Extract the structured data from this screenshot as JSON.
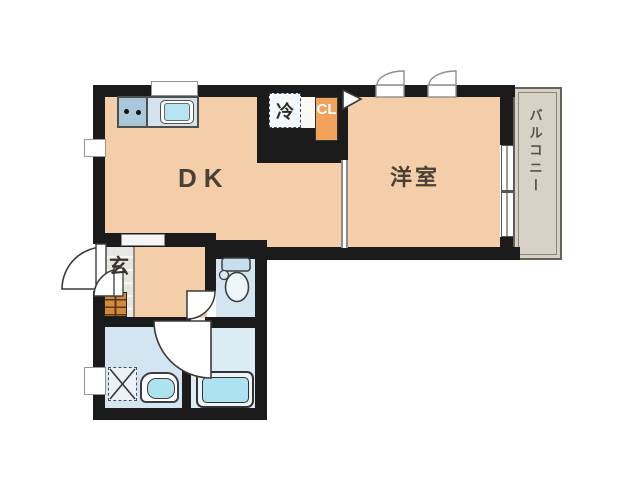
{
  "plan": {
    "title": "apartment-floor-plan",
    "rooms": {
      "dk_label": "DK",
      "western_room_label": "洋室",
      "balcony_label": "バルコニー",
      "entrance_label": "玄",
      "closet_label": "CL",
      "refrigerator_label": "冷"
    },
    "colors": {
      "room_fill": "#f4cda9",
      "wet_area_fill": "#d2e5f1",
      "wall": "#1b1b1b",
      "closet_orange": "#f1a35c",
      "fixture_cyan": "#aee2f0",
      "balcony_fill": "#d8d2c6",
      "shoe_cabinet": "#d28a3e",
      "entrance_tile": "#e7e6e1"
    }
  }
}
